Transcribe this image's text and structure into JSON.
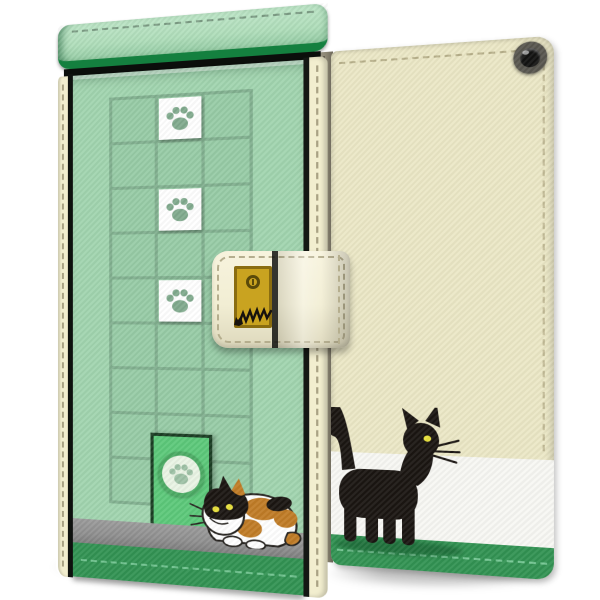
{
  "product": {
    "type": "flip-style smartphone wallet case, product photo",
    "theme": "cat apartment: lattice window with paw tiles, cat door, calico cat on front; black cat on back",
    "views": {
      "left": "front cover (closed, angled)",
      "right": "back cover (closed, angled)"
    }
  },
  "front_cover": {
    "top_flap": "light green stitched flap with dark green edge",
    "lattice": {
      "columns": 3,
      "rows": 9
    },
    "paw_tiles": 3,
    "door": {
      "color": "bright green",
      "medallion": "paw print in circle"
    },
    "cat": "calico cat crouching beside door",
    "step": "gray ledge",
    "bottom_band": "green with stitch line"
  },
  "back_cover": {
    "camera_hole": true,
    "bands_top_to_bottom": [
      "cream",
      "white",
      "green"
    ],
    "cat": "black cat with yellow eye walking right",
    "stitched_edges": true,
    "phone_edge_visible": true
  },
  "clasp_belt": {
    "material": "cream leather with stitching",
    "charm": "gold plate with keyhole and cat scratch marks"
  },
  "colors": {
    "page_bg": "#ffffff",
    "front_face_green": "#a0d4ae",
    "roof_light_green": "#aeddb9",
    "roof_edge_green": "#14803f",
    "lattice_line_green": "#7fae8d",
    "door_green": "#5ac878",
    "door_frame": "#173a20",
    "door_ring_green": "#49aa62",
    "door_ring_inner": "#e9f4e4",
    "paw_on_white": "#7fa98c",
    "paw_on_door": "#9cc0a4",
    "step_gray": "#8e8e8e",
    "band_green": "#2f9150",
    "stitch_green": "#7fcf9e",
    "stitch_cream": "#b7b08a",
    "cream_leather": "#ebe7c5",
    "cream_edge": "#f2eecf",
    "white_band": "#f7f7f3",
    "spine_brown": "#8a8472",
    "phone_gap_dark": "#23262c",
    "belt_cream": "#f2eed4",
    "charm_gold": "#c9a320",
    "charm_frame": "#8a6d10",
    "keyhole_dark": "#5a4a0a",
    "calico_orange": "#bf7a23",
    "cat_black": "#17120e",
    "cat_eye_yellow": "#e8e13a",
    "shadow": "rgba(0,0,0,0.22)"
  }
}
